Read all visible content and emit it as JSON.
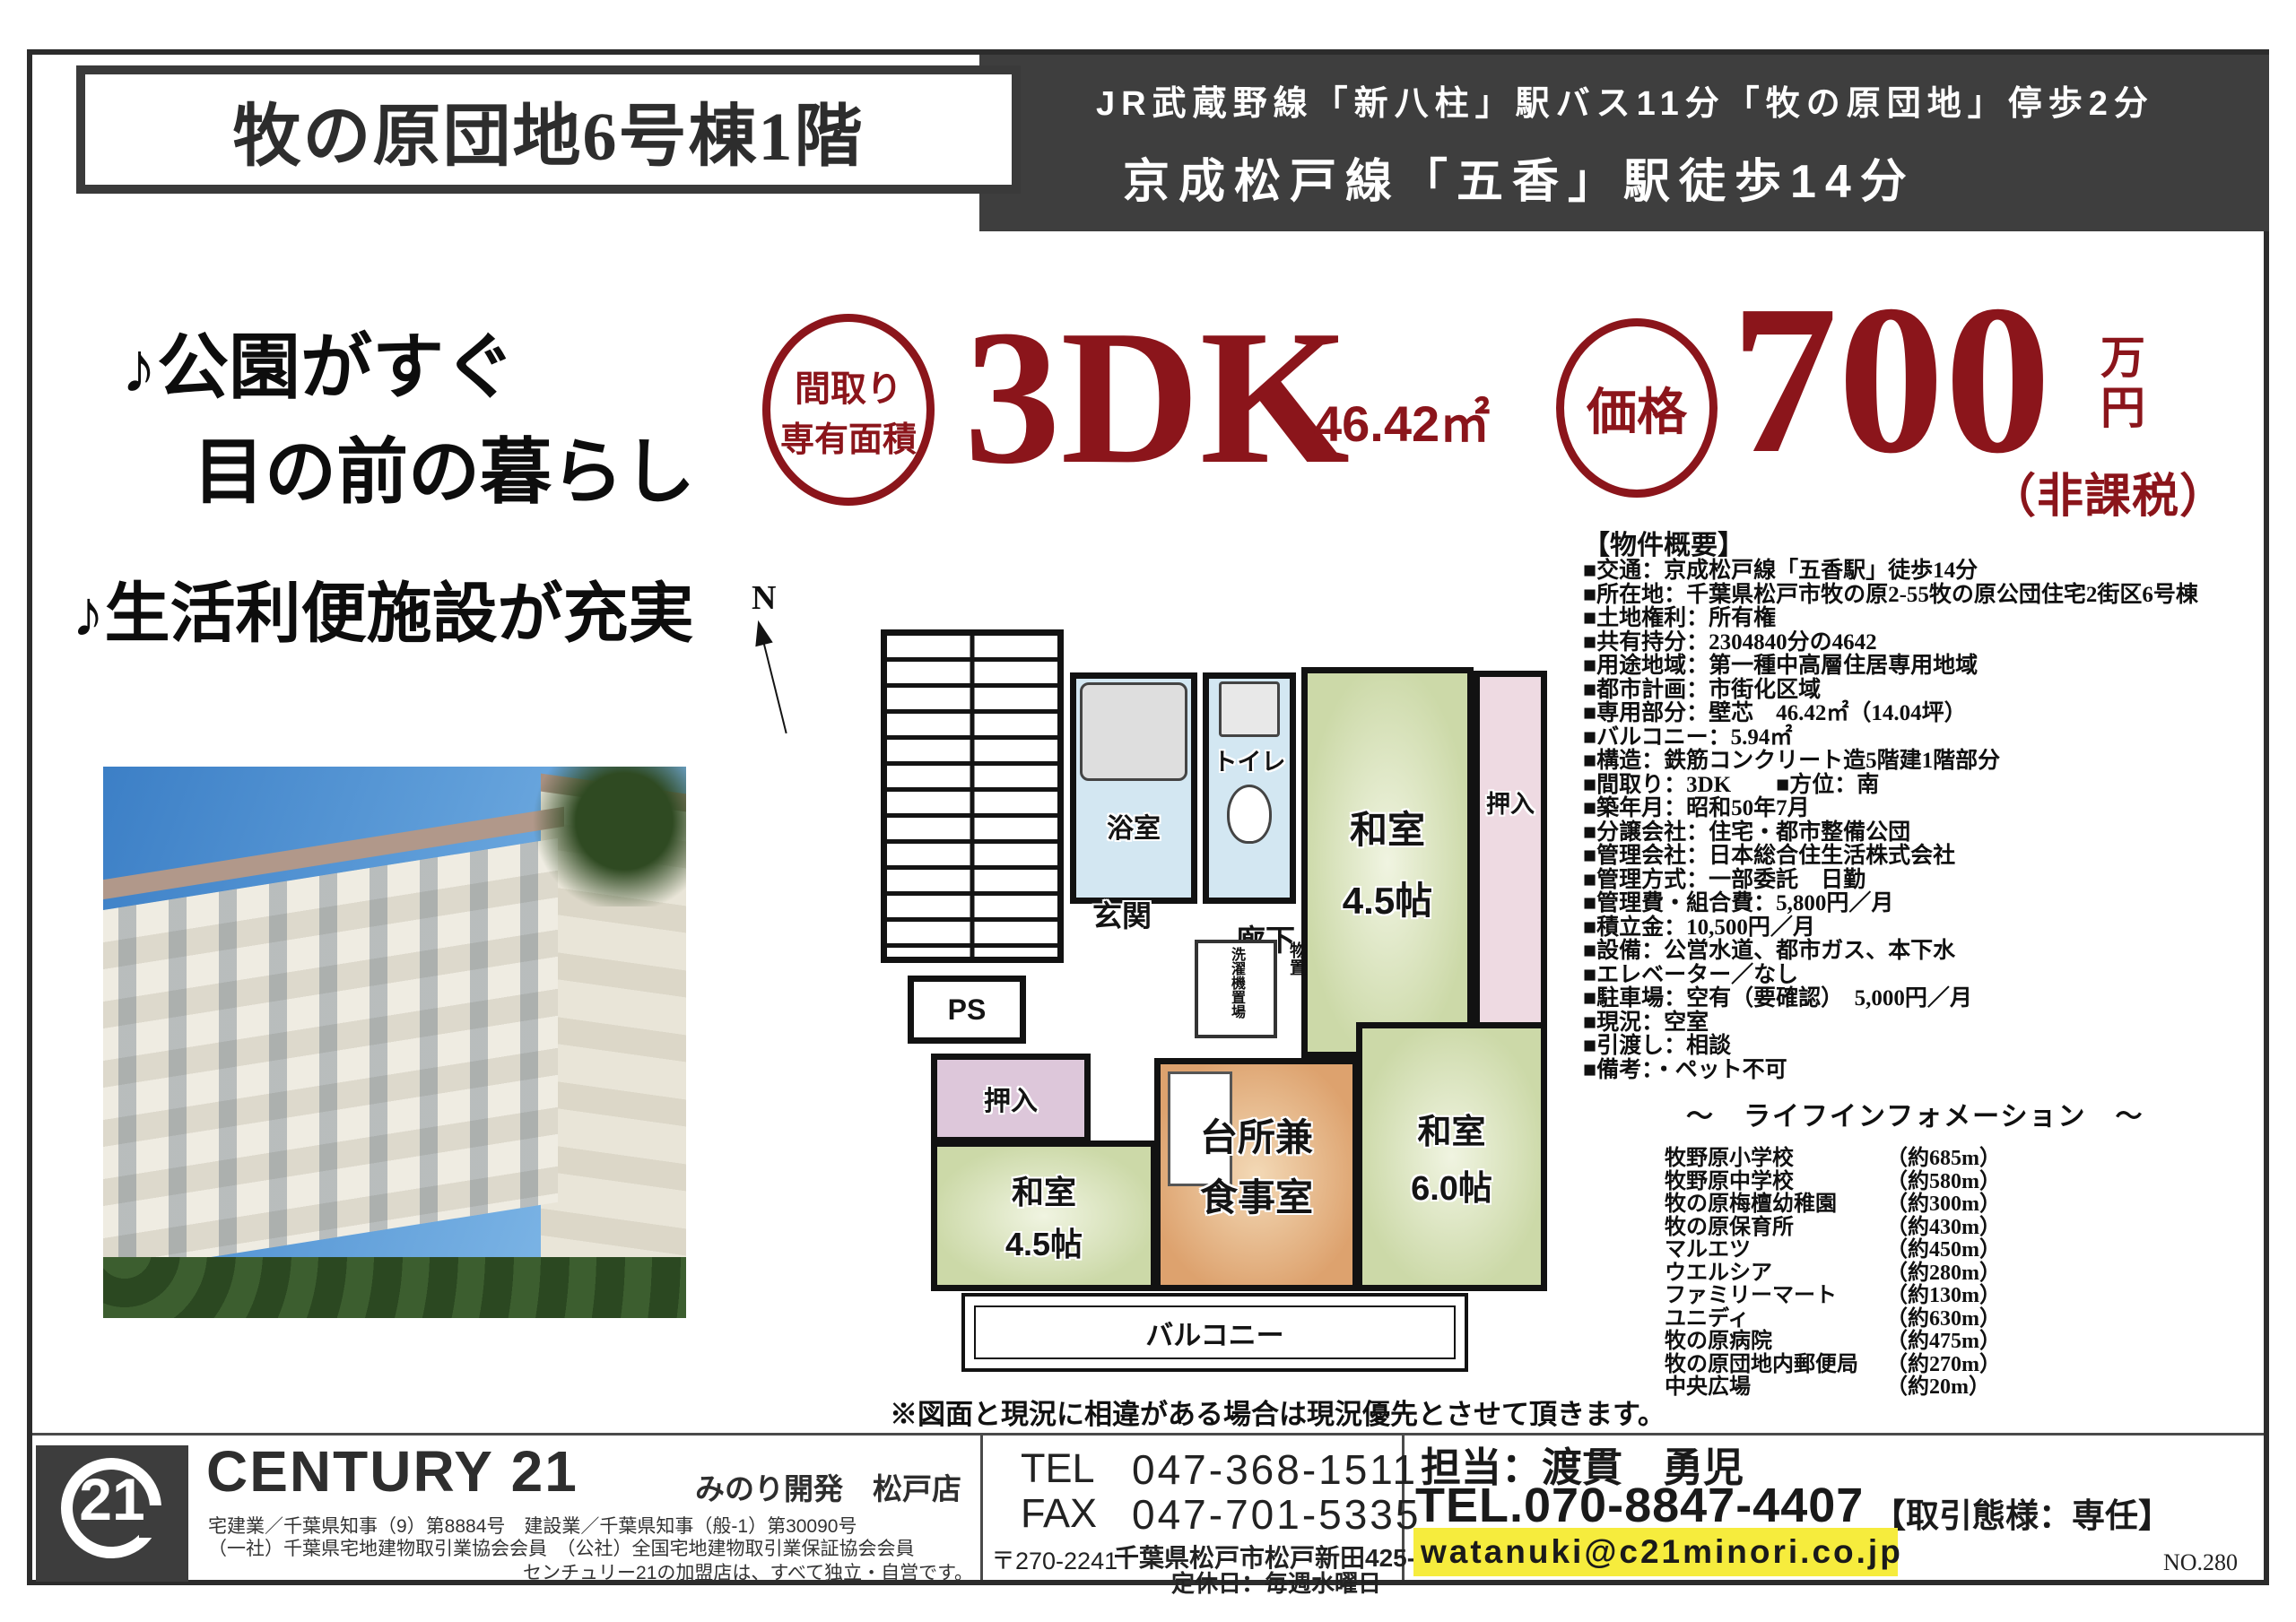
{
  "colors": {
    "accent_red": "#8b151b",
    "header_dark": "#3e3e3e",
    "highlight_yellow": "#f6ec3d"
  },
  "header": {
    "title": "牧の原団地6号棟1階",
    "access_line1": "JR武蔵野線「新八柱」駅バス11分「牧の原団地」停歩2分",
    "access_line2": "京成松戸線「五香」駅徒歩14分"
  },
  "catchphrase": {
    "line1": "♪公園がすぐ",
    "line2": "目の前の暮らし",
    "line3": "♪生活利便施設が充実"
  },
  "highlights": {
    "layout_badge_line1": "間取り",
    "layout_badge_line2": "専有面積",
    "layout_value": "3DK",
    "area_value": "46.42㎡",
    "price_badge": "価格",
    "price_value": "700",
    "price_unit": "万円",
    "price_tax_note": "（非課税）"
  },
  "overview": {
    "heading": "【物件概要】",
    "items": [
      "■交通：京成松戸線「五香駅」徒歩14分",
      "■所在地：千葉県松戸市牧の原2-55牧の原公団住宅2街区6号棟",
      "■土地権利：所有権",
      "■共有持分：2304840分の4642",
      "■用途地域：第一種中高層住居専用地域",
      "■都市計画：市街化区域",
      "■専用部分：壁芯　46.42㎡（14.04坪）",
      "■バルコニー：5.94㎡",
      "■構造：鉄筋コンクリート造5階建1階部分",
      "■間取り：3DK　　■方位：南",
      "■築年月：昭和50年7月",
      "■分譲会社：住宅・都市整備公団",
      "■管理会社：日本総合住生活株式会社",
      "■管理方式：一部委託　日勤",
      "■管理費・組合費：5,800円／月",
      "■積立金：10,500円／月",
      "■設備：公営水道、都市ガス、本下水",
      "■エレベーター／なし",
      "■駐車場：空有（要確認）　5,000円／月",
      "■現況：空室",
      "■引渡し：相談",
      "■備考：・ペット不可"
    ]
  },
  "life_info": {
    "heading": "～　ライフインフォメーション　～",
    "items": [
      {
        "name": "牧野原小学校",
        "distance": "（約685m）"
      },
      {
        "name": "牧野原中学校",
        "distance": "（約580m）"
      },
      {
        "name": "牧の原梅檀幼稚園",
        "distance": "（約300m）"
      },
      {
        "name": "牧の原保育所",
        "distance": "（約430m）"
      },
      {
        "name": "マルエツ",
        "distance": "（約450m）"
      },
      {
        "name": "ウエルシア",
        "distance": "（約280m）"
      },
      {
        "name": "ファミリーマート",
        "distance": "（約130m）"
      },
      {
        "name": "ユニディ",
        "distance": "（約630m）"
      },
      {
        "name": "牧の原病院",
        "distance": "（約475m）"
      },
      {
        "name": "牧の原団地内郵便局",
        "distance": "（約270m）"
      },
      {
        "name": "中央広場",
        "distance": "（約20m）"
      }
    ]
  },
  "floor_plan": {
    "compass": "N",
    "bathroom": "浴室",
    "toilet": "トイレ",
    "laundry": "洗濯機置場",
    "storage": "物置",
    "entrance": "玄関",
    "hallway": "廊下",
    "pipe_space": "PS",
    "closet_ne": "押入",
    "closet_w": "押入",
    "room_ne_name": "和室",
    "room_ne_size": "4.5帖",
    "room_sw_name": "和室",
    "room_sw_size": "4.5帖",
    "room_se_name": "和室",
    "room_se_size": "6.0帖",
    "kitchen_line1": "台所兼",
    "kitchen_line2": "食事室",
    "balcony": "バルコニー",
    "note": "※図面と現況に相違がある場合は現況優先とさせて頂きます。"
  },
  "footer": {
    "brand": "CENTURY 21",
    "brand_mark": "21",
    "store": "みのり開発　松戸店",
    "license1": "宅建業／千葉県知事（9）第8884号　建設業／千葉県知事（般-1）第30090号",
    "license2": "（一社）千葉県宅地建物取引業協会会員　（公社）全国宅地建物取引業保証協会会員",
    "franchise_note": "センチュリー21の加盟店は、すべて独立・自営です。",
    "tel_label": "TEL",
    "tel": "047-368-1511",
    "fax_label": "FAX",
    "fax": "047-701-5335",
    "postal": "〒270-2241",
    "address": "千葉県松戸市松戸新田425-4",
    "closed": "定休日：毎週水曜日",
    "agent": "担当：渡貫　勇児",
    "agent_tel": "TEL.070-8847-4407",
    "transaction": "【取引態様：専任】",
    "email": "watanuki@c21minori.co.jp",
    "number": "NO.280"
  }
}
